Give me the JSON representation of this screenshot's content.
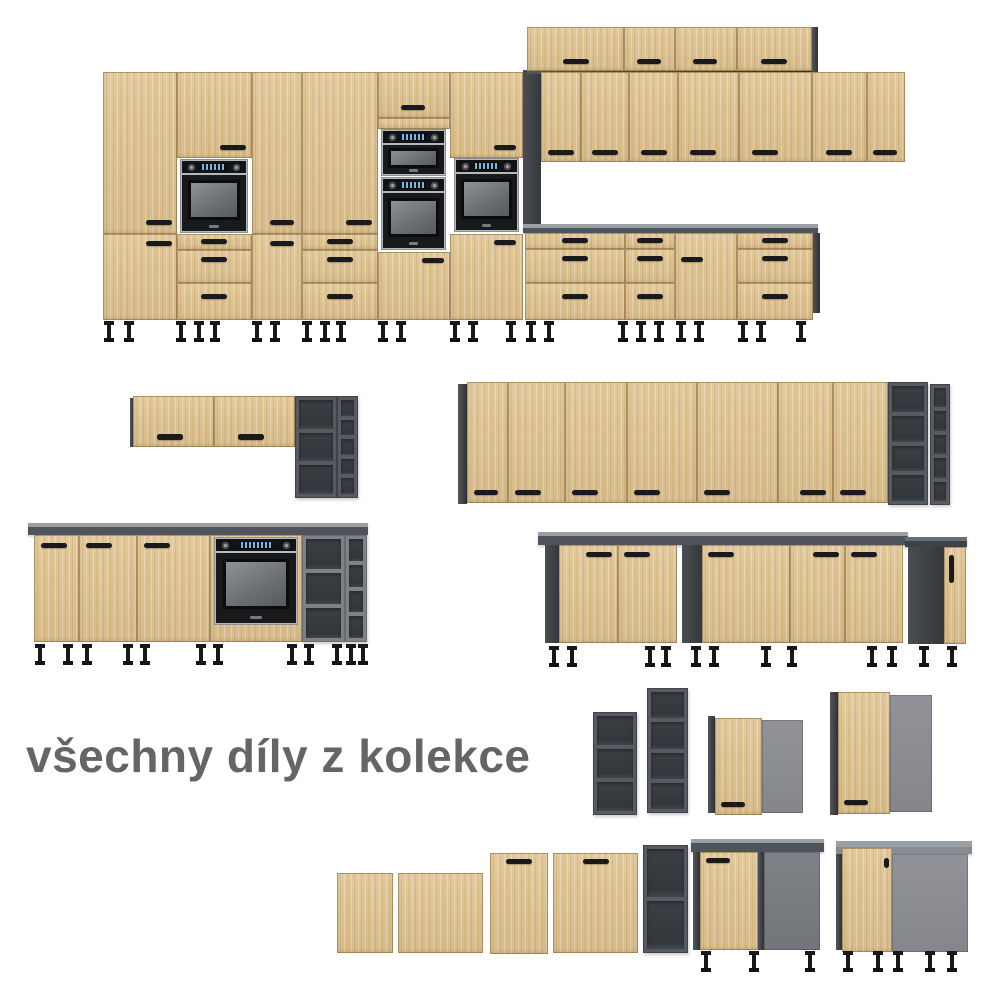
{
  "caption": {
    "text": "všechny díly z kolekce"
  },
  "palette": {
    "background": "#ffffff",
    "wood": "#dfc493",
    "carcass_dark_gray": "#3e4247",
    "shelf_frame_gray": "#565b61",
    "shelf_frame_light_gray": "#7e8287",
    "shelf_interior": "#33363a",
    "corner_panel_gray": "#8c8e93",
    "countertop_front": "#4f545a",
    "countertop_top": "#9ba0a5",
    "handle_black": "#1a1a1c",
    "leg_black": "#17181a",
    "oven_steel": "#b6b9bc",
    "oven_black": "#17191b",
    "oven_display_blue": "#79b7dd",
    "caption_text": "#656565"
  },
  "collection": {
    "pieces": [
      "tall-pantry-run-with-built-in-ovens",
      "upper-wall-cabinet-row",
      "wall-cabinet-row",
      "base-drawer-cabinets",
      "horizontal-flap-wall-cabinets",
      "open-shelf-corner-units",
      "base-run-with-oven-and-countertop",
      "two-door-base-cabinet",
      "three-door-base-cabinet",
      "narrow-end-base-cabinet",
      "corner-wall-cabinets",
      "front-panels-and-doors",
      "corner-base-cabinets"
    ]
  }
}
